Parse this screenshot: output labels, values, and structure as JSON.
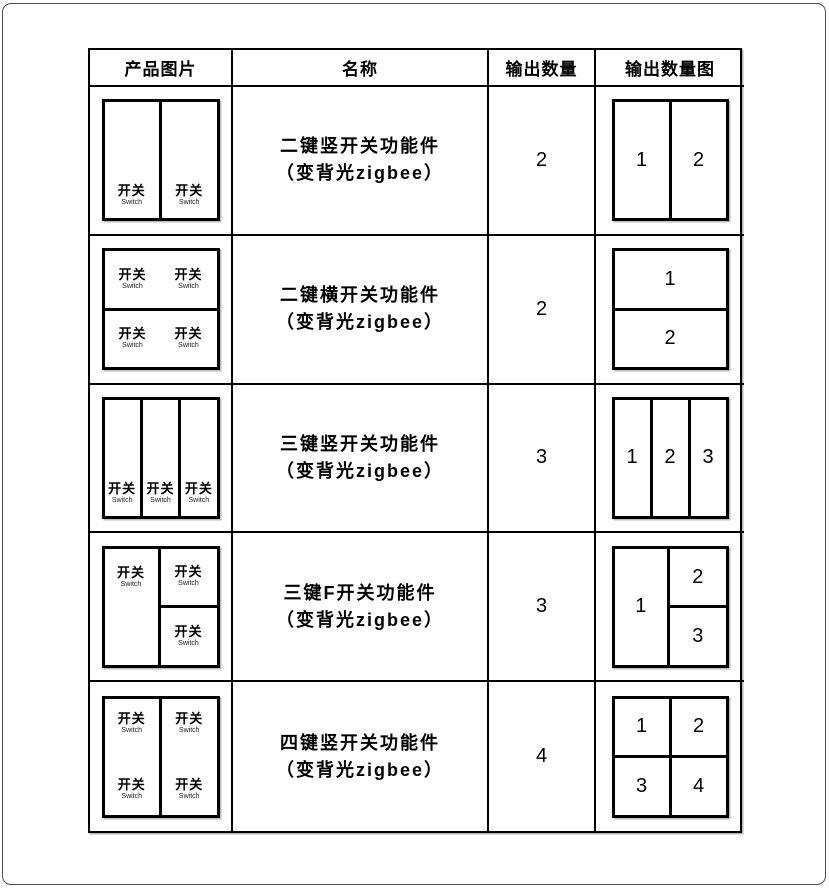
{
  "table": {
    "headers": [
      "产品图片",
      "名称",
      "输出数量",
      "输出数量图"
    ],
    "rows": [
      {
        "name_line1": "二键竖开关功能件",
        "name_line2": "（变背光zigbee）",
        "output_count": "2",
        "product_layout": "2-keys-vertical",
        "diagram_layout": "2-vertical",
        "diagram_labels": [
          "1",
          "2"
        ]
      },
      {
        "name_line1": "二键横开关功能件",
        "name_line2": "（变背光zigbee）",
        "output_count": "2",
        "product_layout": "2-keys-horizontal",
        "diagram_layout": "2-horizontal",
        "diagram_labels": [
          "1",
          "2"
        ]
      },
      {
        "name_line1": "三键竖开关功能件",
        "name_line2": "（变背光zigbee）",
        "output_count": "3",
        "product_layout": "3-keys-vertical",
        "diagram_layout": "3-vertical",
        "diagram_labels": [
          "1",
          "2",
          "3"
        ]
      },
      {
        "name_line1": "三键F开关功能件",
        "name_line2": "（变背光zigbee）",
        "output_count": "3",
        "product_layout": "3-keys-F",
        "diagram_layout": "F-1-left-2-3-right",
        "diagram_labels": [
          "1",
          "2",
          "3"
        ]
      },
      {
        "name_line1": "四键竖开关功能件",
        "name_line2": "（变背光zigbee）",
        "output_count": "4",
        "product_layout": "4-keys-2x2-on-2-vertical-rockers",
        "diagram_layout": "2x2-grid",
        "diagram_labels": [
          "1",
          "2",
          "3",
          "4"
        ]
      }
    ]
  },
  "labels": {
    "switch_zh": "开关",
    "switch_en": "Switch"
  },
  "colors": {
    "background": "#ffffff",
    "table_border": "#000000",
    "frame_border": "#4f4f4f",
    "text": "#000000"
  }
}
